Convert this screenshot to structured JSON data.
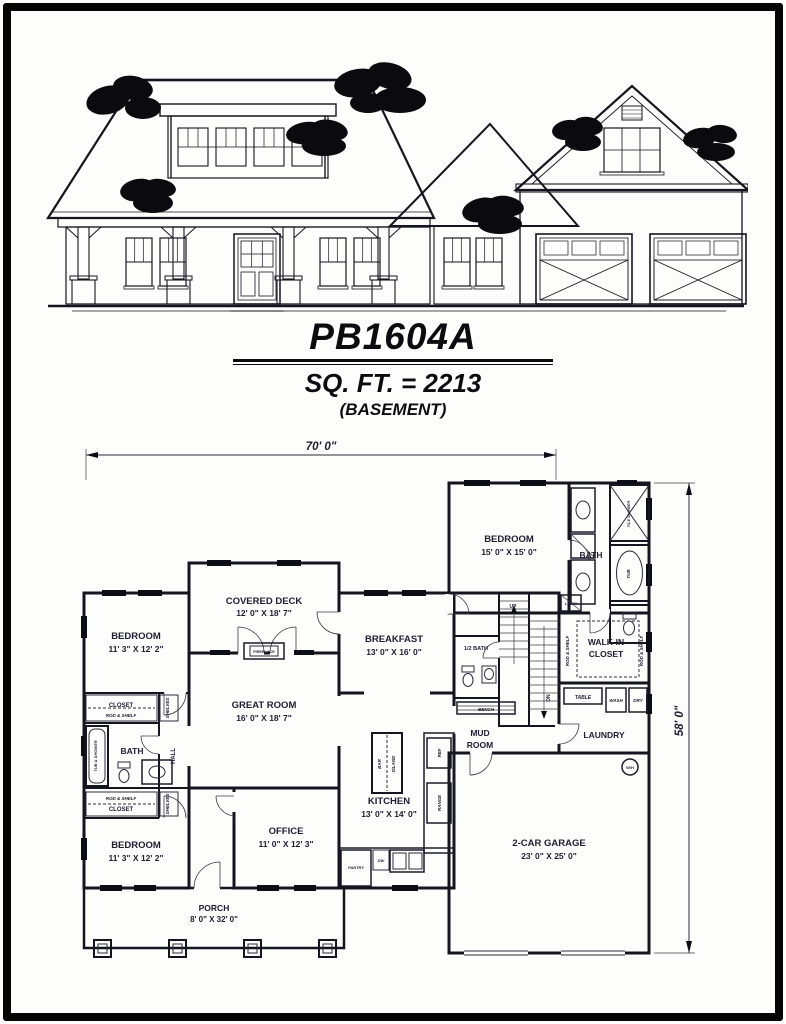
{
  "title_block": {
    "plan_number": "PB1604A",
    "square_footage": "SQ. FT. = 2213",
    "basement_note": "(BASEMENT)"
  },
  "plan": {
    "overall_width": "70' 0\"",
    "overall_depth": "58' 0\"",
    "rooms": {
      "covered_deck": {
        "name": "COVERED DECK",
        "dims": "12' 0\" X 18' 7\""
      },
      "bedroom_top_right": {
        "name": "BEDROOM",
        "dims": "15' 0\" X 15' 0\""
      },
      "bath_right": {
        "name": "BATH"
      },
      "breakfast": {
        "name": "BREAKFAST",
        "dims": "13' 0\" X 16' 0\""
      },
      "bedroom_top_left": {
        "name": "BEDROOM",
        "dims": "11' 3\" X 12' 2\""
      },
      "bath_left": {
        "name": "BATH"
      },
      "hall": {
        "name": "HALL"
      },
      "great_room": {
        "name": "GREAT ROOM",
        "dims": "16' 0\" X 18' 7\""
      },
      "bedroom_bottom_left": {
        "name": "BEDROOM",
        "dims": "11' 3\" X 12' 2\""
      },
      "office": {
        "name": "OFFICE",
        "dims": "11' 0\" X 12' 3\""
      },
      "kitchen": {
        "name": "KITCHEN",
        "dims": "13' 0\" X 14' 0\""
      },
      "half_bath": {
        "name": "1/2 BATH"
      },
      "mud_room": {
        "line1": "MUD",
        "line2": "ROOM"
      },
      "walk_in_closet": {
        "line1": "WALK-IN",
        "line2": "CLOSET"
      },
      "laundry": {
        "name": "LAUNDRY"
      },
      "garage": {
        "name": "2-CAR GARAGE",
        "dims": "23' 0\" X 25' 0\""
      },
      "porch": {
        "name": "PORCH",
        "dims": "8' 0\" X 32' 0\""
      }
    },
    "fixtures": {
      "fireplace": "FIREPLACE",
      "bar": "BAR",
      "island": "ISLAND",
      "ref": "REF",
      "range": "RANGE",
      "pantry": "PANTRY",
      "dw": "DW",
      "closet": "CLOSET",
      "rod_shelf": "ROD & SHELF",
      "shelves": "SHELVES",
      "bench": "BENCH",
      "table": "TABLE",
      "wash": "WASH",
      "dry": "DRY",
      "linen": "LINEN",
      "up": "UP",
      "down": "DN",
      "water_heater": "W/H",
      "tile_shower": "TILE SHOWER",
      "tub": "TUB",
      "tub_shower": "TUB & SHOWER"
    }
  }
}
